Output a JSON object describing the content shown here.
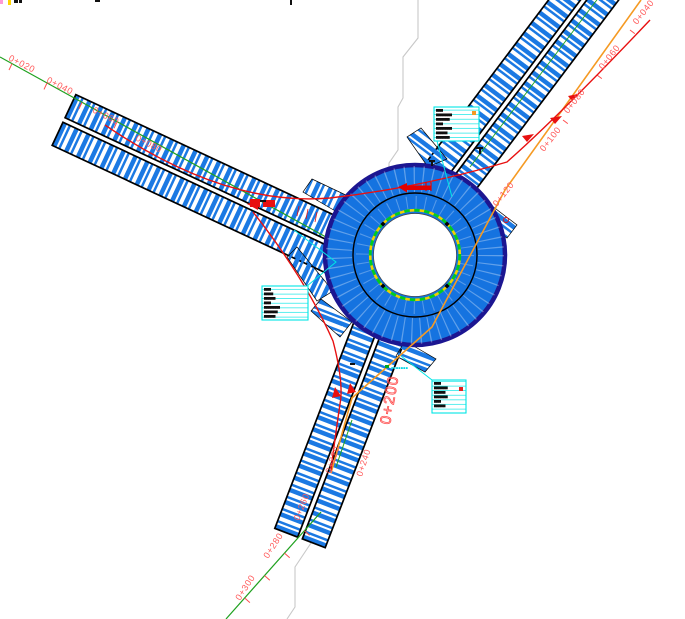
{
  "drawing": {
    "type": "roundabout-intersection-plan",
    "colors": {
      "road_fill": "#1573e0",
      "hatch": "#1b79e3",
      "rim": "#1c1691",
      "centerline": "#1fa11f",
      "station_text": "#ff5a5a",
      "leader": "#00e5e5",
      "apron_ring_dash": "#00cc22",
      "apron_ring_base": "#f0d000",
      "utility_line": "#f59a23",
      "boundary_line": "#c8c8c8",
      "swept_path": "#e81010"
    },
    "stations": {
      "left_arm": [
        "0+020",
        "0+040",
        "0+060",
        "0+080"
      ],
      "right_arm": [
        "0+040",
        "0+060",
        "0+080",
        "0+100",
        "0+120"
      ],
      "bottom_arm": [
        "0+200",
        "0+220",
        "0+240",
        "0+260",
        "0+280",
        "0+300"
      ]
    },
    "annotations": {
      "box_right": {
        "lines": [
          "▆▆▆",
          "▆▆▆▆▆▆▆",
          "▆▆▆▆▆▆",
          "▆▆▆",
          "▆▆▆▆▆▆▆",
          "▆▆▆▆▆",
          "▆▆▆▆▆▆"
        ]
      },
      "box_left": {
        "lines": [
          "▆▆▆",
          "▆▆▆▆",
          "▆▆▆▆▆",
          "▆▆▆",
          "▆▆▆▆▆▆▆",
          "▆▆▆▆▆▆",
          "▆▆▆▆▆"
        ]
      },
      "box_bottom": {
        "lines": [
          "▆▆▆",
          "▆▆▆▆▆▆",
          "▆▆▆▆▆",
          "▆▆▆▆▆▆",
          "▆▆▆",
          "▆▆▆▆▆"
        ]
      },
      "road_note": "▪▪▪▪▪▪▪"
    }
  }
}
